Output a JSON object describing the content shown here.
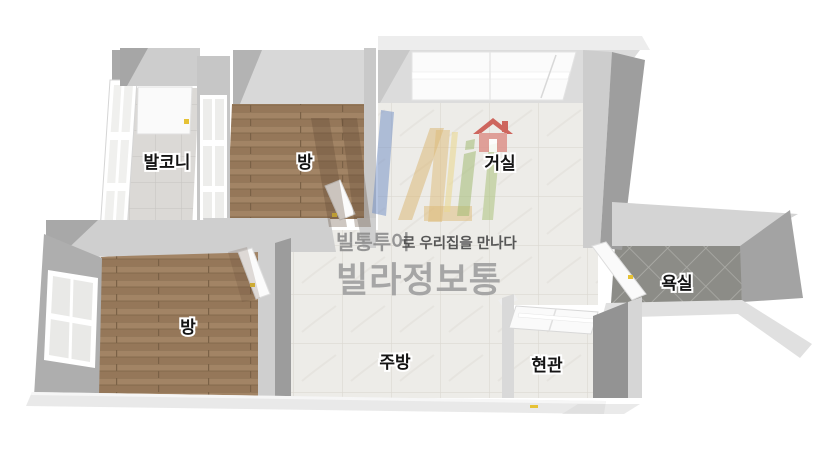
{
  "title": "3D apartment floor plan",
  "rooms": {
    "balcony": {
      "label": "발코니",
      "floor": "light-tile"
    },
    "bedroom_top": {
      "label": "방",
      "floor": "wood"
    },
    "living": {
      "label": "거실",
      "floor": "marble-tile"
    },
    "bathroom": {
      "label": "욕실",
      "floor": "dark-tile"
    },
    "bedroom_bottom": {
      "label": "방",
      "floor": "wood"
    },
    "kitchen": {
      "label": "주방",
      "floor": "marble-tile"
    },
    "entrance": {
      "label": "현관",
      "floor": "marble-tile"
    }
  },
  "watermark": {
    "brand_bold": "빌통투어",
    "tagline_rest": "로 우리집을 만나다",
    "brand_large": "빌라정보통"
  },
  "icons": {
    "house": "red house icon above living room label"
  },
  "colors": {
    "wall_light": "#d6d6d6",
    "wall_side": "#a6a6a6",
    "wall_dark": "#939393",
    "wood_floor": "#9b7d5e",
    "tile_light": "#edece8",
    "tile_dark": "#8c8c87",
    "door_handle_accent": "#e6c235",
    "house_icon_red": "#c94f46"
  }
}
